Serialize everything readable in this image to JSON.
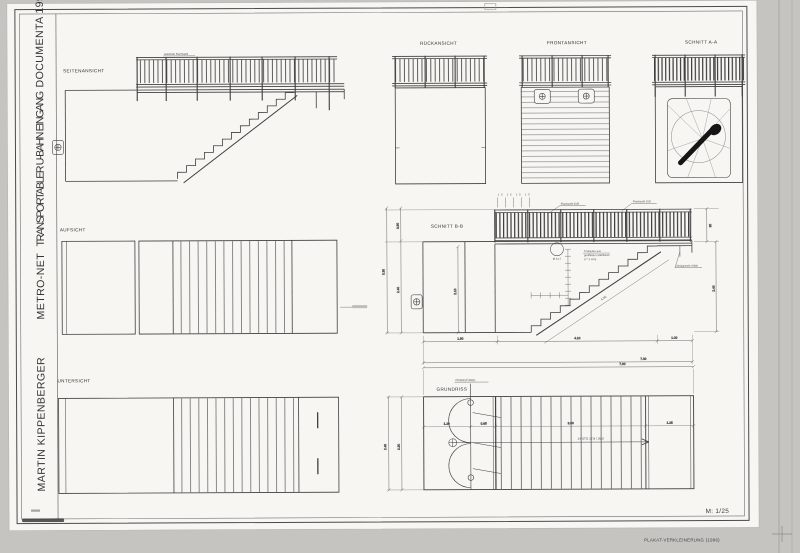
{
  "photo": {
    "caption": "PLAKAT-VERKLEINERUNG (1996)"
  },
  "palette": {
    "photo_bg": "#c5c4c1",
    "paper": "#f7f6f2",
    "ink": "#3f3f3f"
  },
  "sheet": {
    "scale": "M: 1/25",
    "title": {
      "line1": "MARTIN KIPPENBERGER",
      "line2": "METRO-NET",
      "line3": "TRANSPORTABLER U-BAHN EINGANG",
      "line4": "DOCUMENTA 1997"
    }
  },
  "views": {
    "seitenansicht": {
      "label": "SEITENANSICHT",
      "railing_note": "Geländer Flachstahl"
    },
    "rueckansicht": {
      "label": "RÜCKANSICHT"
    },
    "frontansicht": {
      "label": "FRONTANSICHT"
    },
    "schnitt_aa": {
      "label": "SCHNITT A-A"
    },
    "aufsicht": {
      "label": "AUFSICHT"
    },
    "untersicht": {
      "label": "UNTERSICHT"
    },
    "schnitt_bb": {
      "label": "SCHNITT B-B",
      "dims": {
        "tick_row": "15 15 15 15",
        "rail_height": "0.90",
        "box_height": "2.40",
        "height_total": "3.30",
        "inner_height": "2.10",
        "right_rail": "90",
        "right_height": "2.40",
        "stringer": "4.30",
        "seg_left": "1.90",
        "seg_mid": "4.10",
        "seg_right": "1.00",
        "total_width": "7.00"
      },
      "notes": {
        "rail1": "Flachstahl 40/8",
        "rail2": "Flachstahl 30/5",
        "detail": "Ø 33,7",
        "steps1": "Trittstufen aus",
        "steps2": "geriffeltem Stahlblech",
        "steps3": "(t = 3 mm)",
        "support": "Vierkantrohr 60/40"
      }
    },
    "grundriss": {
      "label": "GRUNDRISS",
      "door_note": "PENDELTÜREN",
      "stair_note": "14 STG 17,8 / 26,0",
      "dims": {
        "total": "7.00",
        "seg1": "1.20",
        "seg2": "0.65",
        "seg3": "3.90",
        "seg4": "1.25",
        "depth": "2.40",
        "depth_inner": "2.30"
      }
    }
  }
}
